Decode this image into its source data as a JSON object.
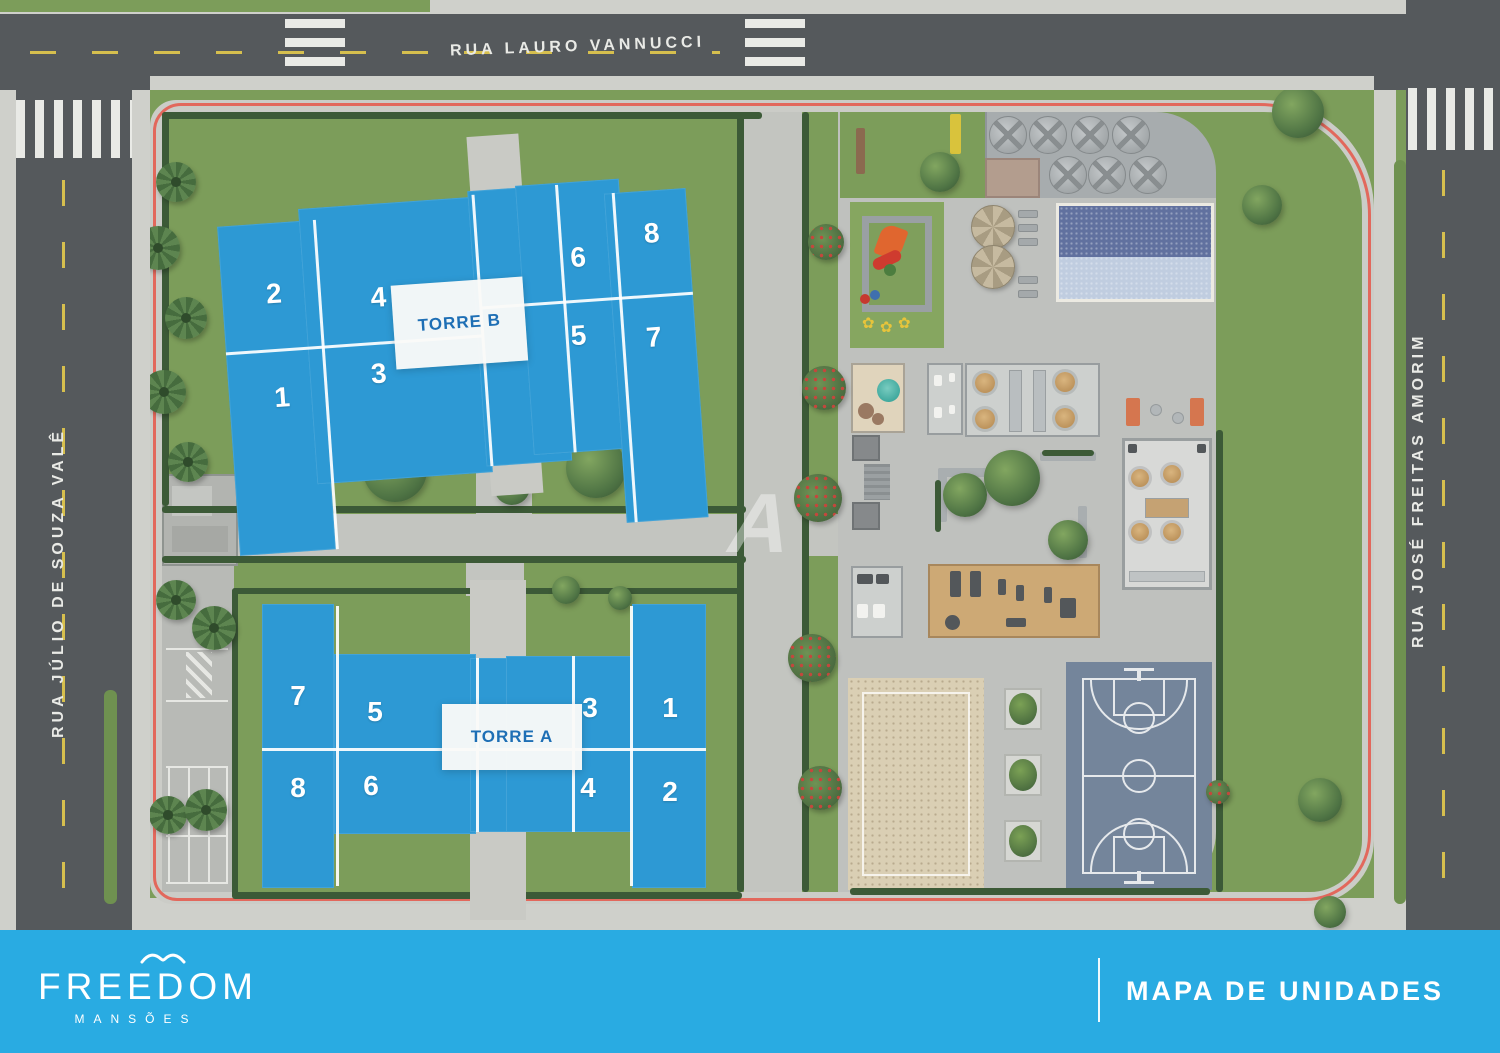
{
  "map": {
    "streets": {
      "top": "RUA LAURO VANNUCCI",
      "left": "RUA JÚLIO DE SOUZA VALÊ",
      "right": "RUA JOSÉ FREITAS AMORIM"
    },
    "watermark": "A",
    "towers": [
      {
        "id": "torre-b",
        "label": "TORRE B",
        "units": [
          {
            "label": "2",
            "x": 52,
            "y": 135
          },
          {
            "label": "4",
            "x": 156,
            "y": 146
          },
          {
            "label": "6",
            "x": 358,
            "y": 120
          },
          {
            "label": "8",
            "x": 433,
            "y": 101
          },
          {
            "label": "1",
            "x": 53,
            "y": 239
          },
          {
            "label": "3",
            "x": 151,
            "y": 222
          },
          {
            "label": "5",
            "x": 353,
            "y": 198
          },
          {
            "label": "7",
            "x": 428,
            "y": 205
          }
        ]
      },
      {
        "id": "torre-a",
        "label": "TORRE A",
        "units": [
          {
            "label": "7",
            "x": 60,
            "y": 100
          },
          {
            "label": "5",
            "x": 137,
            "y": 116
          },
          {
            "label": "3",
            "x": 352,
            "y": 112
          },
          {
            "label": "1",
            "x": 432,
            "y": 112
          },
          {
            "label": "8",
            "x": 60,
            "y": 192
          },
          {
            "label": "6",
            "x": 133,
            "y": 190
          },
          {
            "label": "4",
            "x": 350,
            "y": 192
          },
          {
            "label": "2",
            "x": 432,
            "y": 196
          }
        ]
      }
    ],
    "vents": [
      {
        "x": 1008,
        "y": 135
      },
      {
        "x": 1048,
        "y": 135
      },
      {
        "x": 1090,
        "y": 135
      },
      {
        "x": 1131,
        "y": 135
      },
      {
        "x": 1068,
        "y": 175
      },
      {
        "x": 1107,
        "y": 175
      },
      {
        "x": 1148,
        "y": 175
      }
    ],
    "umbrellas": [
      {
        "x": 993,
        "y": 227
      },
      {
        "x": 993,
        "y": 267
      }
    ],
    "loungers": [
      {
        "x": 1018,
        "y": 210
      },
      {
        "x": 1018,
        "y": 224
      },
      {
        "x": 1018,
        "y": 238
      },
      {
        "x": 1018,
        "y": 276
      },
      {
        "x": 1018,
        "y": 290
      }
    ],
    "planters": [
      {
        "x": 1004,
        "y": 688
      },
      {
        "x": 1004,
        "y": 754
      },
      {
        "x": 1004,
        "y": 820
      }
    ],
    "parking_lines": [
      {
        "x": 166,
        "y": 648,
        "w": 62,
        "h": 2
      },
      {
        "x": 166,
        "y": 700,
        "w": 62,
        "h": 2
      },
      {
        "x": 166,
        "y": 766,
        "w": 62,
        "h": 2
      },
      {
        "x": 166,
        "y": 835,
        "w": 62,
        "h": 2
      },
      {
        "x": 166,
        "y": 882,
        "w": 62,
        "h": 2
      },
      {
        "x": 168,
        "y": 766,
        "w": 2,
        "h": 116
      },
      {
        "x": 188,
        "y": 766,
        "w": 2,
        "h": 116
      },
      {
        "x": 208,
        "y": 766,
        "w": 2,
        "h": 116
      },
      {
        "x": 226,
        "y": 766,
        "w": 2,
        "h": 116
      }
    ],
    "vegetation": [
      {
        "t": "palm",
        "cx": 176,
        "cy": 182,
        "r": 20
      },
      {
        "t": "palm",
        "cx": 158,
        "cy": 248,
        "r": 22
      },
      {
        "t": "palm",
        "cx": 186,
        "cy": 318,
        "r": 21
      },
      {
        "t": "palm",
        "cx": 164,
        "cy": 392,
        "r": 22
      },
      {
        "t": "palm",
        "cx": 188,
        "cy": 462,
        "r": 20
      },
      {
        "t": "palm",
        "cx": 176,
        "cy": 600,
        "r": 20
      },
      {
        "t": "palm",
        "cx": 214,
        "cy": 628,
        "r": 22
      },
      {
        "t": "palm",
        "cx": 168,
        "cy": 815,
        "r": 19
      },
      {
        "t": "palm",
        "cx": 206,
        "cy": 810,
        "r": 21
      },
      {
        "t": "tree",
        "cx": 395,
        "cy": 470,
        "r": 32
      },
      {
        "t": "tree",
        "cx": 596,
        "cy": 468,
        "r": 30
      },
      {
        "t": "tree",
        "cx": 512,
        "cy": 487,
        "r": 18
      },
      {
        "t": "tree",
        "cx": 566,
        "cy": 590,
        "r": 14
      },
      {
        "t": "tree",
        "cx": 620,
        "cy": 598,
        "r": 12
      },
      {
        "t": "tree",
        "cx": 940,
        "cy": 172,
        "r": 20
      },
      {
        "t": "tree",
        "cx": 1298,
        "cy": 112,
        "r": 26
      },
      {
        "t": "tree",
        "cx": 1262,
        "cy": 205,
        "r": 20
      },
      {
        "t": "tree",
        "cx": 965,
        "cy": 495,
        "r": 22
      },
      {
        "t": "tree",
        "cx": 1012,
        "cy": 478,
        "r": 28
      },
      {
        "t": "tree",
        "cx": 1068,
        "cy": 540,
        "r": 20
      },
      {
        "t": "tree",
        "cx": 1320,
        "cy": 800,
        "r": 22
      },
      {
        "t": "tree",
        "cx": 1330,
        "cy": 912,
        "r": 16
      },
      {
        "t": "fbush",
        "cx": 824,
        "cy": 388,
        "r": 22
      },
      {
        "t": "fbush",
        "cx": 818,
        "cy": 498,
        "r": 24
      },
      {
        "t": "fbush",
        "cx": 812,
        "cy": 658,
        "r": 24
      },
      {
        "t": "fbush",
        "cx": 820,
        "cy": 788,
        "r": 22
      },
      {
        "t": "fbush",
        "cx": 826,
        "cy": 242,
        "r": 18
      },
      {
        "t": "fbush",
        "cx": 1218,
        "cy": 792,
        "r": 12
      }
    ],
    "playground_flowers": [
      "✿",
      "✿",
      "✿"
    ]
  },
  "footer": {
    "brand": "FREEDOM",
    "brand_subtitle": "MANSÕES",
    "title": "MAPA DE UNIDADES"
  },
  "colors": {
    "footer_cyan": "#29abe2",
    "building_blue": "#2d99d4",
    "tower_label_blue": "#1e6fb5",
    "grass": "#7c9d5a",
    "road": "#55595c",
    "sidewalk": "#cfd0cb",
    "deck": "#bfc1be",
    "hedge": "#3c5a37",
    "curb_line": "#e2685c",
    "pool_dark": "#61719f",
    "pool_light": "#c0cde0",
    "court_blue": "#74859b",
    "sand": "#dacfb4"
  }
}
